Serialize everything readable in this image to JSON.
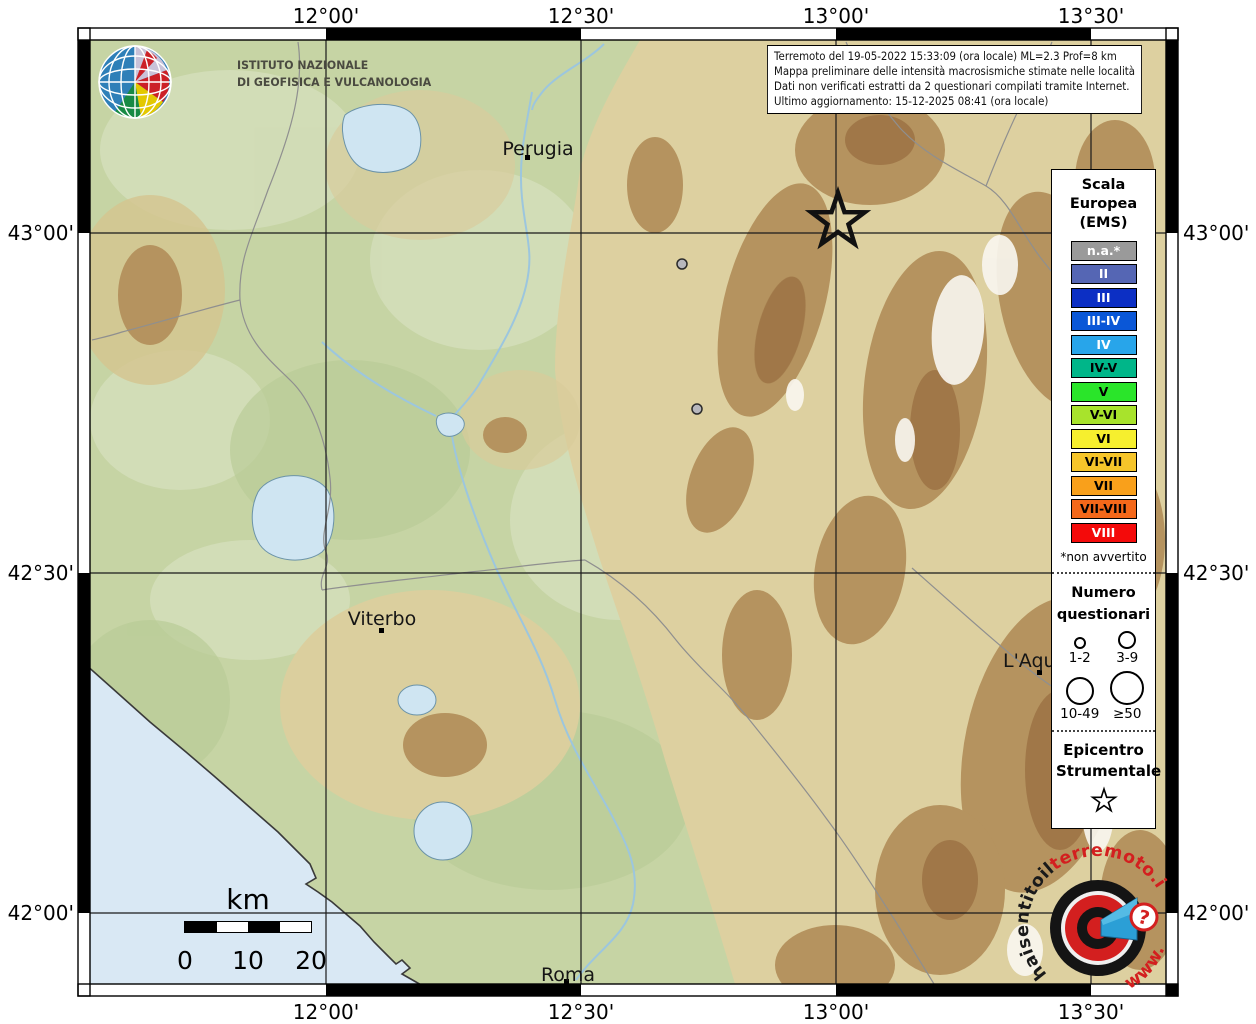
{
  "branding": {
    "institute_line1": "ISTITUTO NAZIONALE",
    "institute_line2": "DI GEOFISICA E VULCANOLOGIA"
  },
  "info_box": {
    "line1": "Terremoto del 19-05-2022 15:33:09 (ora locale) ML=2.3 Prof=8 km",
    "line2": "Mappa preliminare delle intensità macrosismiche stimate nelle località",
    "line3": "Dati non verificati estratti da 2 questionari compilati tramite Internet.",
    "line4": "Ultimo aggiornamento: 15-12-2025 08:41 (ora locale)"
  },
  "axes": {
    "lon": [
      "12°00'",
      "12°30'",
      "13°00'",
      "13°30'"
    ],
    "lat": [
      "43°00'",
      "42°30'",
      "42°00'"
    ]
  },
  "legend": {
    "title1": "Scala",
    "title2": "Europea",
    "title3": "(EMS)",
    "items": [
      {
        "label": "n.a.*",
        "color": "#9a9a9a",
        "text_color": "#ffffff"
      },
      {
        "label": "II",
        "color": "#5566b4",
        "text_color": "#ffffff"
      },
      {
        "label": "III",
        "color": "#0c2fc4",
        "text_color": "#ffffff"
      },
      {
        "label": "III-IV",
        "color": "#0a57d7",
        "text_color": "#ffffff"
      },
      {
        "label": "IV",
        "color": "#28a5ea",
        "text_color": "#ffffff"
      },
      {
        "label": "IV-V",
        "color": "#00b689",
        "text_color": "#000000"
      },
      {
        "label": "V",
        "color": "#2ae52a",
        "text_color": "#000000"
      },
      {
        "label": "V-VI",
        "color": "#a8e32c",
        "text_color": "#000000"
      },
      {
        "label": "VI",
        "color": "#f6ef2e",
        "text_color": "#000000"
      },
      {
        "label": "VI-VII",
        "color": "#f6c52a",
        "text_color": "#000000"
      },
      {
        "label": "VII",
        "color": "#f9a01b",
        "text_color": "#000000"
      },
      {
        "label": "VII-VIII",
        "color": "#f4681a",
        "text_color": "#000000"
      },
      {
        "label": "VIII",
        "color": "#f40a0a",
        "text_color": "#ffffff"
      }
    ],
    "footnote": "*non avvertito",
    "questionnaires": {
      "title1": "Numero",
      "title2": "questionari",
      "size1": "1-2",
      "size2": "3-9",
      "size3": "10-49",
      "size4": "≥50"
    },
    "epicenter_title1": "Epicentro",
    "epicenter_title2": "Strumentale"
  },
  "cities": {
    "perugia": "Perugia",
    "viterbo": "Viterbo",
    "laquila": "L'Aquila",
    "roma": "Roma"
  },
  "scale_bar": {
    "unit": "km",
    "tick0": "0",
    "tick1": "10",
    "tick2": "20"
  },
  "site_logo": {
    "arc_black": "haisentitoil",
    "arc_red": "terremoto.it",
    "arc_www": "www.",
    "question": "?"
  }
}
